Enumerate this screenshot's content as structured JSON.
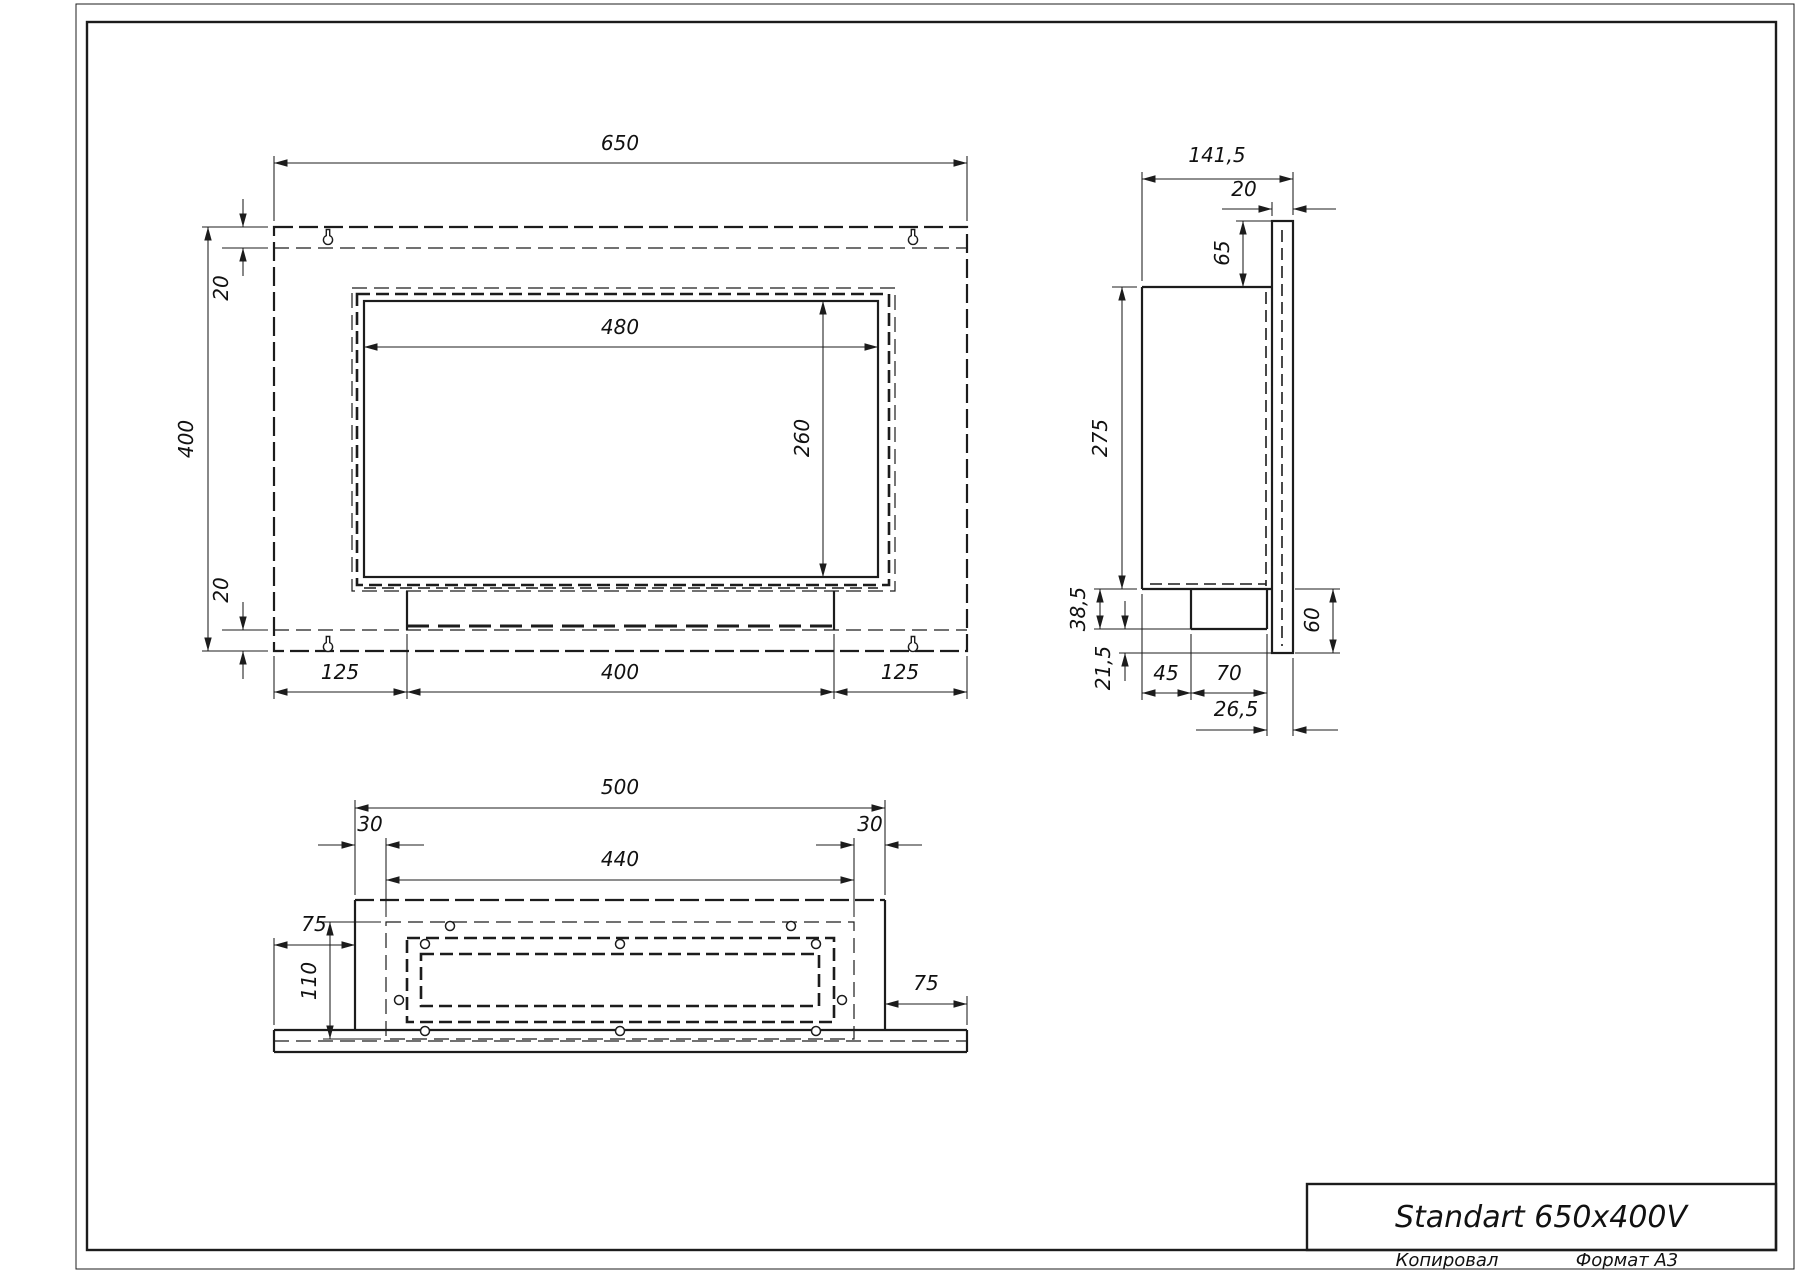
{
  "title_block": {
    "title": "Standart 650x400V",
    "copied_label": "Копировал",
    "format_label": "Формат А3"
  },
  "views": {
    "front": {
      "dims": {
        "overall_width": "650",
        "overall_height": "400",
        "opening_width": "480",
        "opening_height": "260",
        "top_margin": "20",
        "bottom_margin": "20",
        "bottom_left": "125",
        "bottom_center": "400",
        "bottom_right": "125"
      }
    },
    "side": {
      "dims": {
        "overall_depth": "141,5",
        "plate_thickness": "20",
        "plate_above_body": "65",
        "body_height": "275",
        "tray_drop": "38,5",
        "plate_below_tray": "21,5",
        "front_to_tray": "45",
        "tray_depth": "70",
        "tray_to_back": "26,5",
        "body_to_plate_bottom": "60"
      }
    },
    "bottom": {
      "dims": {
        "body_width": "500",
        "inset_left": "30",
        "duct_width": "440",
        "inset_right": "30",
        "panel_overhang_left": "75",
        "duct_depth": "110",
        "panel_overhang_right": "75"
      }
    }
  }
}
